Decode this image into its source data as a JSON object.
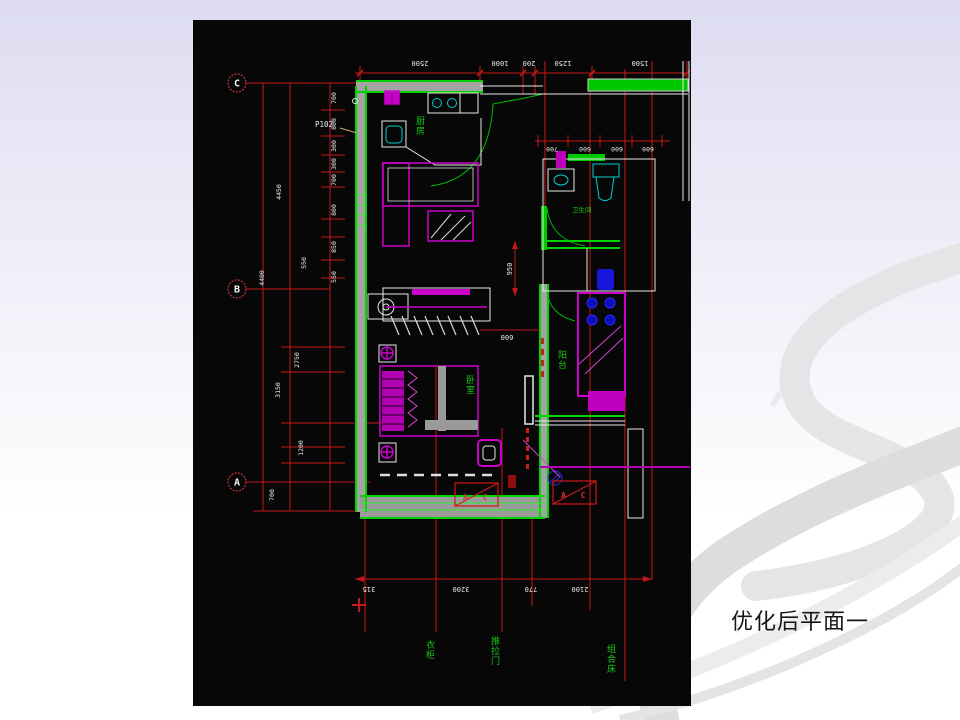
{
  "slide": {
    "caption": "优化后平面一"
  },
  "palette": {
    "background_top": "#dddcf1",
    "background_bottom": "#ffffff",
    "swoosh_gray": "#e3e3e6",
    "canvas_black": "#070707",
    "dimension_red": "#c21818",
    "wall_green": "#00d400",
    "wall_gray": "#a3a3a3",
    "furniture_magenta": "#cc00cc",
    "fixture_cyan": "#00cfcf",
    "fixture_blue": "#1616dd",
    "text_white": "#ececec",
    "label_green": "#17c917"
  },
  "plan": {
    "grid_bubbles": [
      "C",
      "B",
      "A"
    ],
    "tag_p102": "P102",
    "dims": {
      "top": [
        "2500",
        "1000",
        "200",
        "1250",
        "1500"
      ],
      "bath": [
        "700",
        "600",
        "600",
        "600"
      ],
      "left_inner": [
        "700",
        "800",
        "300",
        "300",
        "700",
        "800",
        "850",
        "550"
      ],
      "left_mid": [
        "550",
        "2750",
        "1200"
      ],
      "left_outer": [
        "4450",
        "3150",
        "4400"
      ],
      "below_a": "700",
      "bottom": [
        "315",
        "3200",
        "770",
        "2100"
      ],
      "wardrobe_height": "950",
      "wardrobe_width": "600"
    },
    "rooms": {
      "kitchen": "厨房",
      "bedroom": "卧室",
      "bathroom": "卫生间",
      "balcony": "阳台"
    },
    "callouts": {
      "ac": "A C"
    },
    "bottom_labels": [
      "衣柜",
      "推拉门",
      "组合床"
    ]
  }
}
